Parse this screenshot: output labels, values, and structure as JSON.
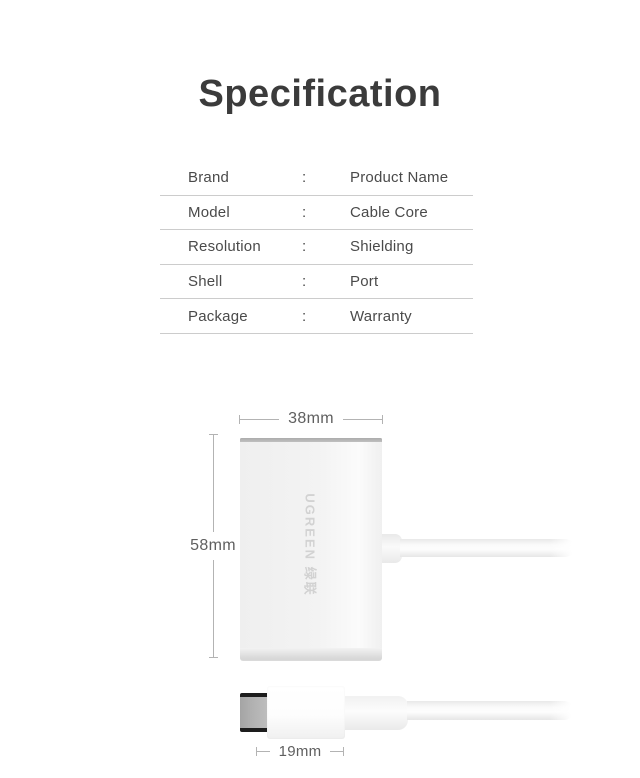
{
  "title": "Specification",
  "spec_table": {
    "colon": ":",
    "rows": [
      {
        "label": "Brand",
        "value": "Product Name"
      },
      {
        "label": "Model",
        "value": "Cable Core"
      },
      {
        "label": "Resolution",
        "value": "Shielding"
      },
      {
        "label": "Shell",
        "value": "Port"
      },
      {
        "label": "Package",
        "value": "Warranty"
      }
    ]
  },
  "diagram": {
    "width_dimension": "38mm",
    "height_dimension": "58mm",
    "plug_width_dimension": "19mm",
    "device_logo": "UGREEN 绿联"
  },
  "colors": {
    "title_text": "#3b3b3b",
    "table_text": "#4a4a4a",
    "table_divider": "#cccccc",
    "dimension_line": "#b3b3b3",
    "dimension_text": "#5f5f5f",
    "device_logo_text": "#d2d2d2",
    "metal_tip": "#b0b0b0"
  }
}
